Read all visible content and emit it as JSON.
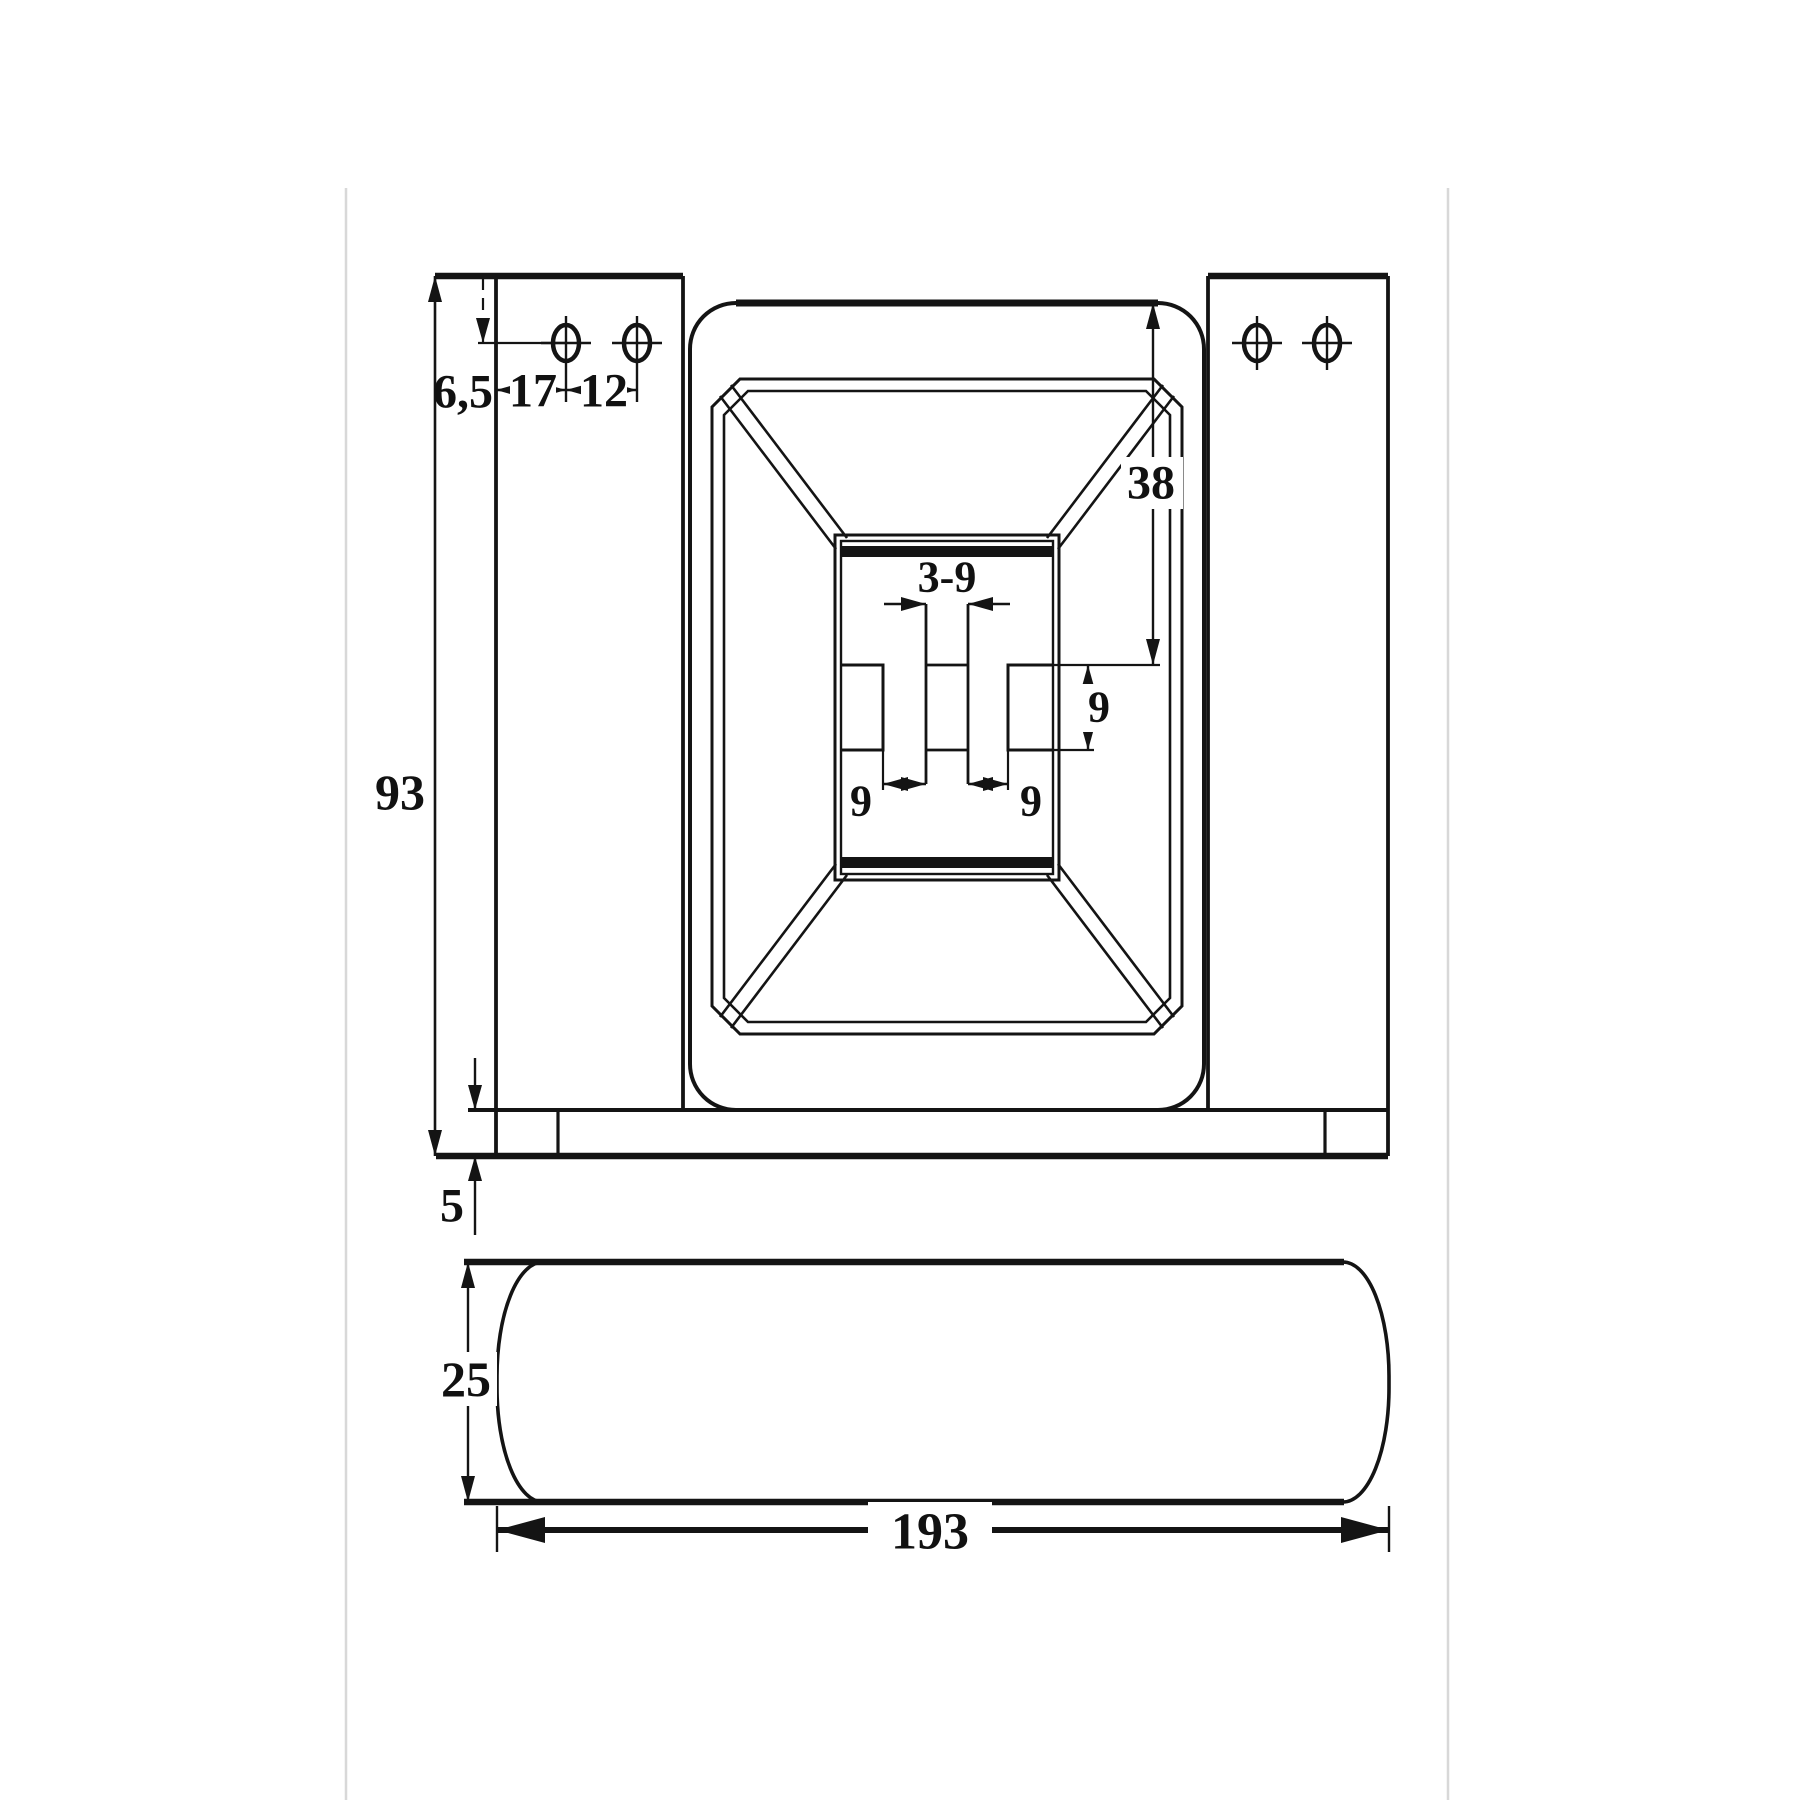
{
  "drawing": {
    "background": "#ffffff",
    "line_color": "#141414",
    "guide_line_color": "#d8d8d8",
    "views": {
      "front": {
        "dimensions": {
          "overall_height": "93",
          "hole_center_from_top": "6,5",
          "hole_from_plate_edge": "17",
          "hole_pitch": "12",
          "recess_depth_from_top": "38",
          "slot_spec": "3-9",
          "slot_gap_left": "9",
          "slot_gap_right": "9",
          "notch_height": "9",
          "base_plate_thickness": "5"
        },
        "mounting_hole_count": 4
      },
      "bottom": {
        "dimensions": {
          "profile_thickness": "25",
          "overall_width": "193"
        }
      }
    }
  }
}
